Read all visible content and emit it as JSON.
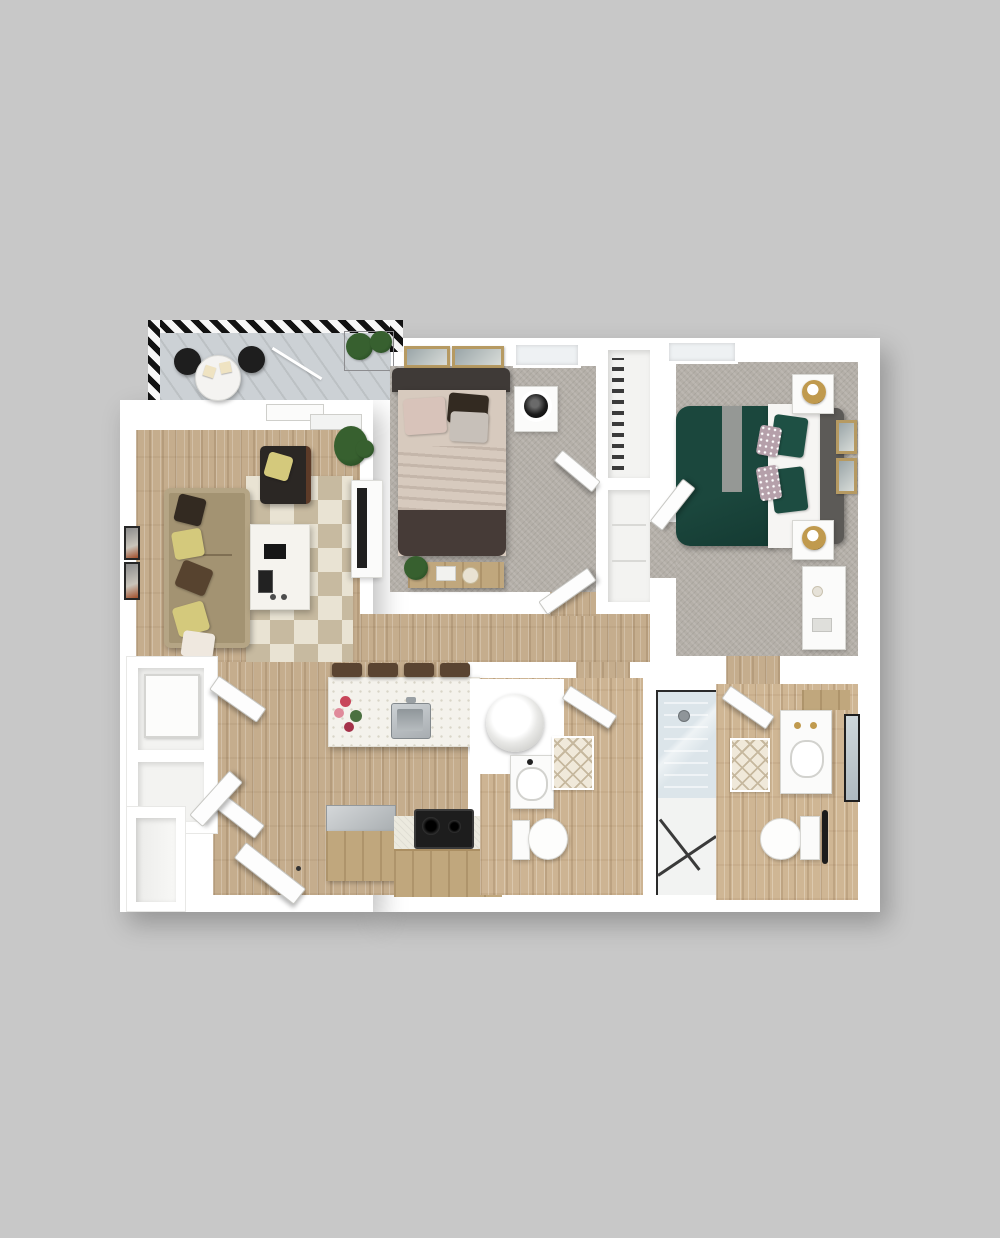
{
  "palette": {
    "bg": "#c8c8c8",
    "wall": "#ffffff",
    "white-soft": "#fdfdfd",
    "fixture-white": "#fbfbfa",
    "wood": "#c5ad8d",
    "carpet": "#b4afa8",
    "rug-base": "#e9e3d3",
    "rug-tri": "#c7baa0",
    "diamond-base": "#f0e9da",
    "diamond-line": "#c6b89e",
    "deck": "#ccd1d5",
    "hatch-dark": "#121212",
    "sofa": "#a39372",
    "sofa-light": "#b5a585",
    "pillow-yellow": "#d4c97c",
    "pillow-brown": "#57432f",
    "pillow-dark": "#332a21",
    "pillow-cream": "#efe8df",
    "chair-dark": "#2b2724",
    "bed1-frame": "#3f3a37",
    "bed1-sheet": "#d7cabe",
    "bed1-foot": "#463b37",
    "bed1-pillow-a": "#d8c3ba",
    "bed1-pillow-b": "#c7c0b9",
    "bed2-green": "#1b473d",
    "bed2-green-deep": "#143a32",
    "bed2-sheet": "#f6f5f3",
    "bed2-headboard": "#5c5a57",
    "accent-mauve": "#b5a0aa",
    "gold": "#c09a4e",
    "steel": "#a8adb1",
    "glass": "#dce5ea",
    "black": "#1b1b1b",
    "cab-wood": "#c0a77d",
    "counter": "#eceadf",
    "cooktop": "#1d1d1d",
    "stool": "#5a4431",
    "plant": "#37602f",
    "plant-dark": "#274b22",
    "frame-tan": "#b69a62",
    "gray-band": "#a09f9c"
  },
  "rooms": [
    "balcony",
    "living-room",
    "bedroom-1",
    "bedroom-2",
    "hallway",
    "kitchen",
    "bathroom-1",
    "bathroom-2",
    "laundry-closet",
    "walk-in-closet",
    "storage-closets",
    "entry"
  ],
  "furniture": [
    "bistro-table",
    "balcony-chairs",
    "planter-box",
    "sofa",
    "armchair",
    "coffee-table",
    "tv-console",
    "area-rug",
    "bed-queen-cream",
    "bed-queen-green",
    "nightstands",
    "lamps",
    "wall-art",
    "bench",
    "kitchen-island",
    "bar-stools",
    "island-sink",
    "flower-bouquet",
    "refrigerator",
    "cooktop",
    "cabinets",
    "washer-dryer",
    "vanities",
    "toilets",
    "walk-in-shower",
    "mirror",
    "door-leaves",
    "windows"
  ]
}
